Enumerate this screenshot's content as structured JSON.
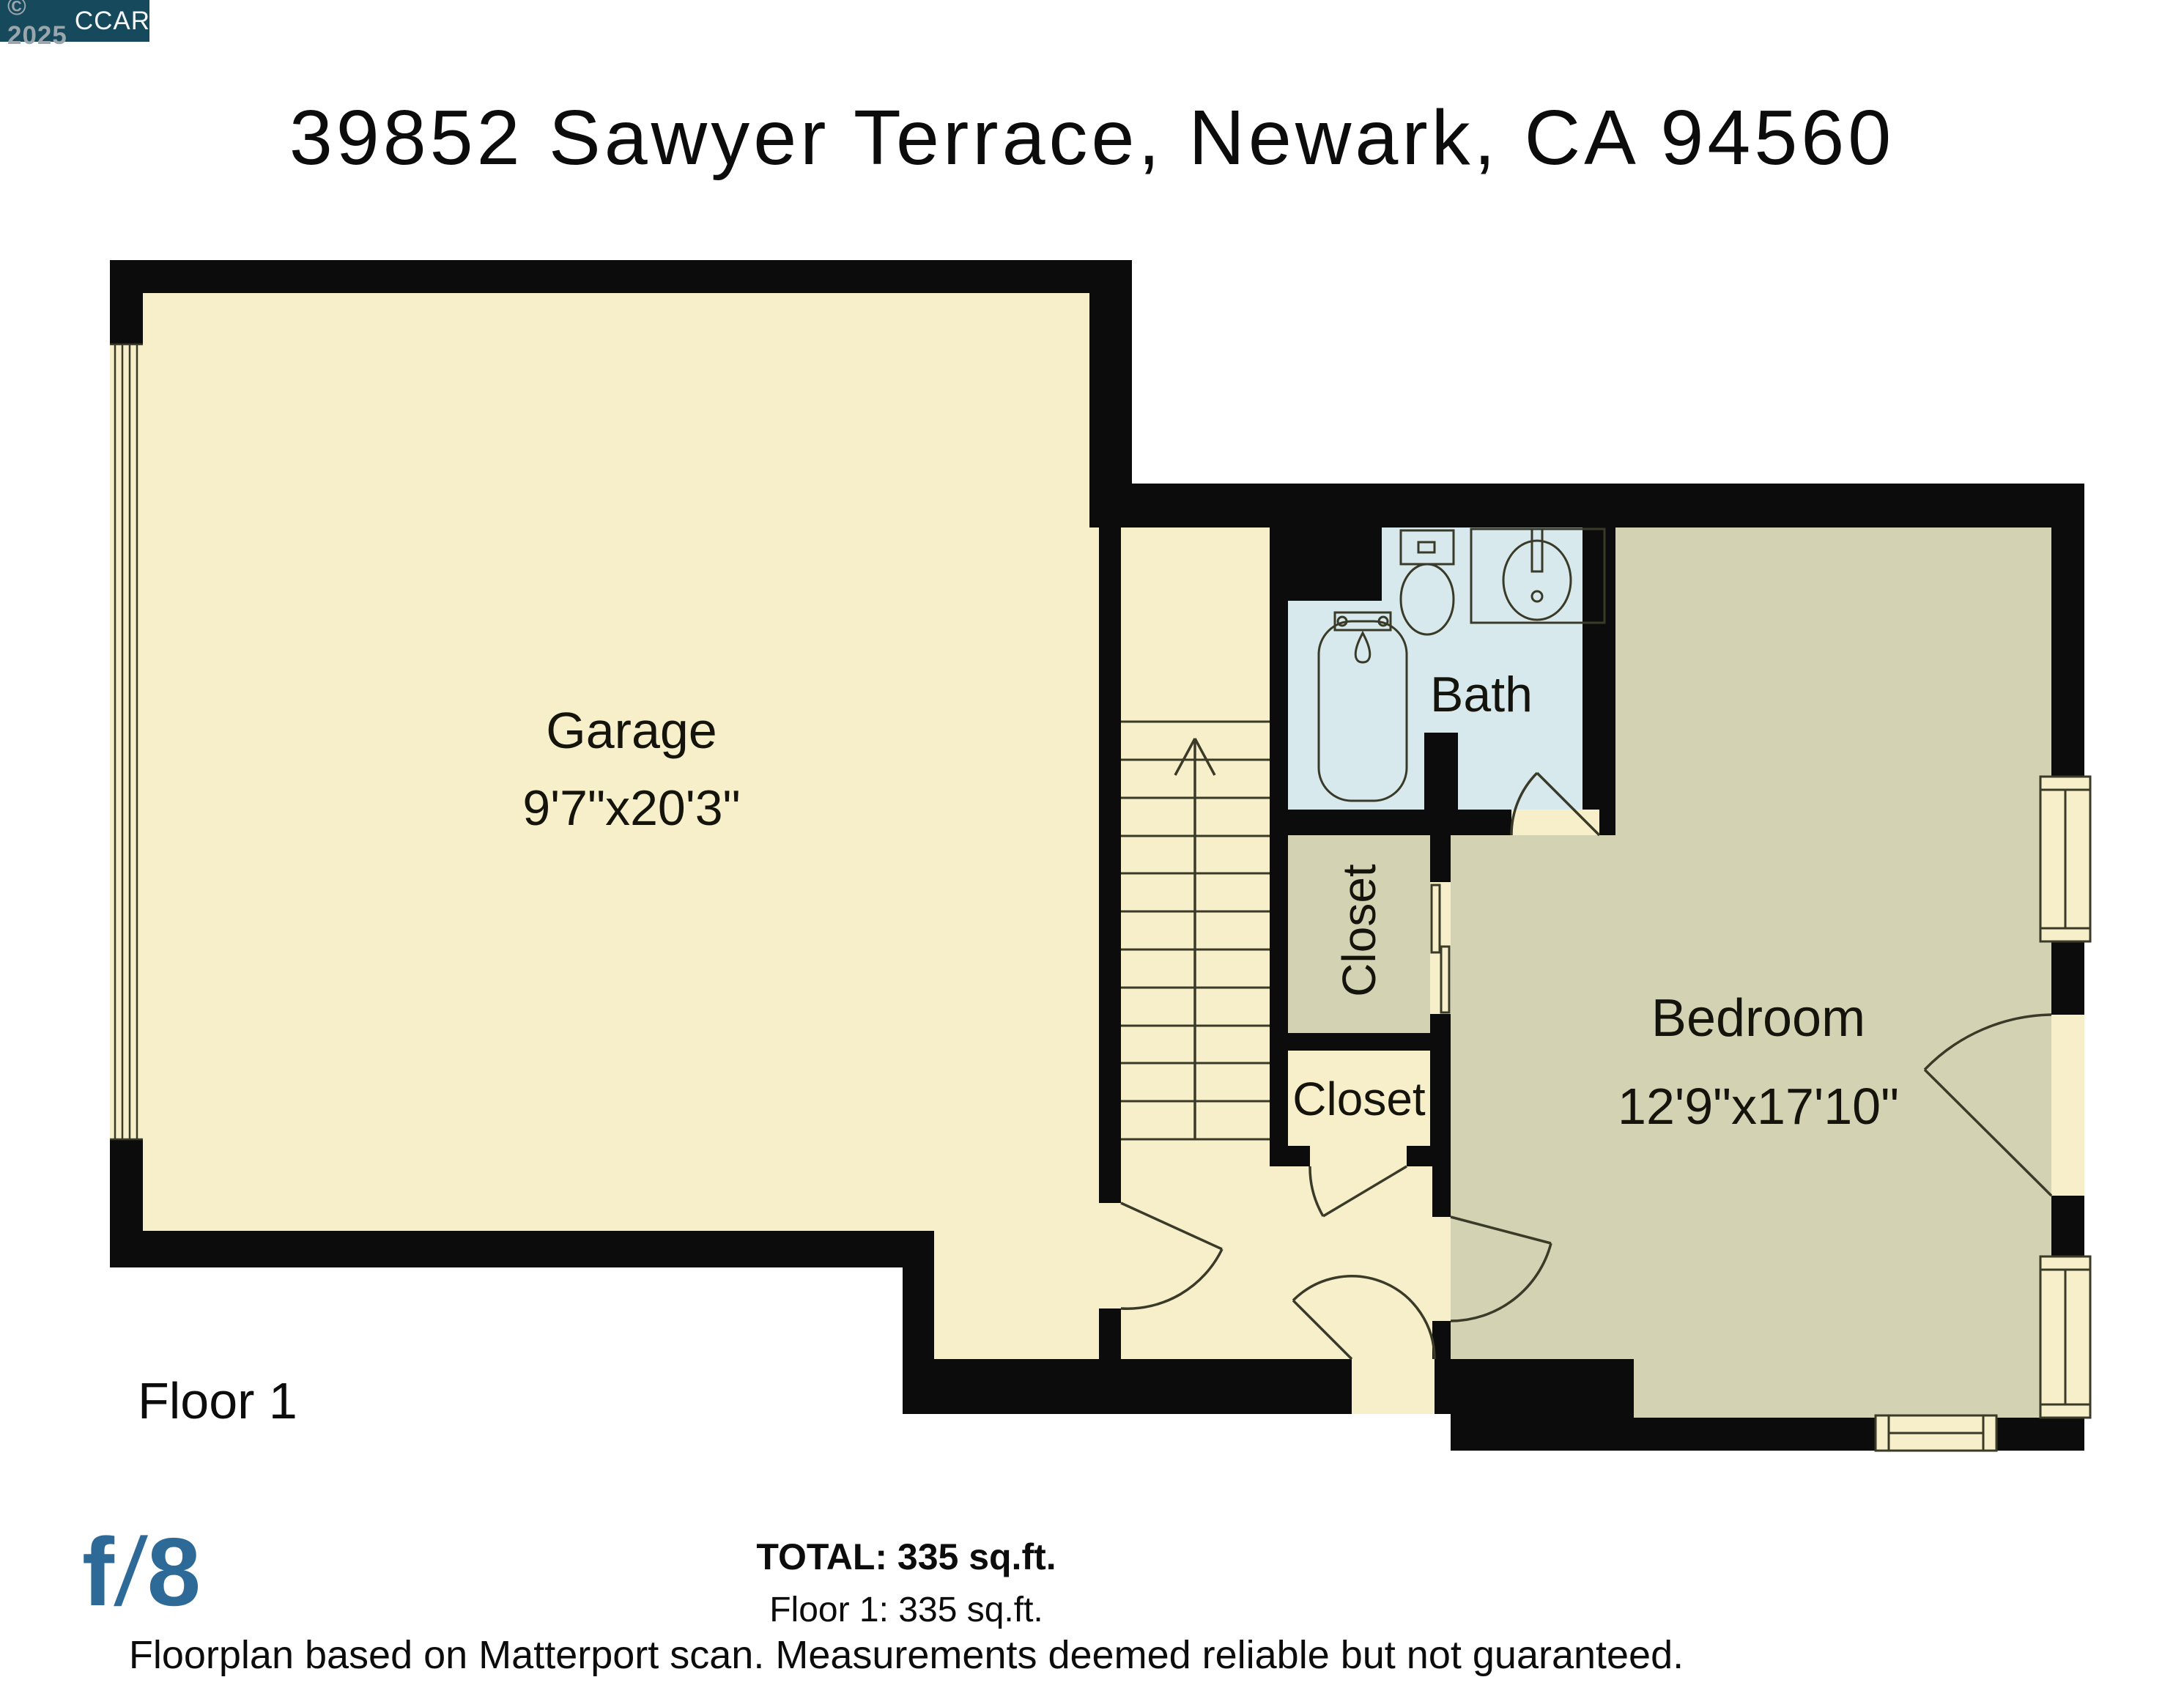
{
  "badge": {
    "copyright": "© 2025",
    "org": "CCAR"
  },
  "title": "39852 Sawyer Terrace, Newark, CA 94560",
  "floor_label": "Floor 1",
  "rooms": {
    "garage": {
      "name": "Garage",
      "dims": "9'7\"x20'3\""
    },
    "bath": {
      "name": "Bath"
    },
    "closet_upper": {
      "name": "Closet"
    },
    "closet_lower": {
      "name": "Closet"
    },
    "bedroom": {
      "name": "Bedroom",
      "dims": "12'9\"x17'10\""
    }
  },
  "stairs": {
    "symbol": "up-arrow",
    "steps": 12
  },
  "summary": {
    "total": "TOTAL: 335 sq.ft.",
    "floor": "Floor 1: 335 sq.ft.",
    "disclaimer": "Floorplan based on Matterport scan. Measurements deemed reliable but not guaranteed."
  },
  "logo": {
    "f": "f",
    "slash": "/",
    "eight": "8"
  },
  "colors": {
    "wall": "#0c0c0c",
    "room_cream": "#f6efc9",
    "room_sage": "#d3d3b4",
    "room_bath_blue": "#d7e9ed",
    "fixture_line": "#3a3a28",
    "badge_bg": "#17495c",
    "badge_muted": "#9aa6ab",
    "logo_blue": "#2d6a98"
  }
}
